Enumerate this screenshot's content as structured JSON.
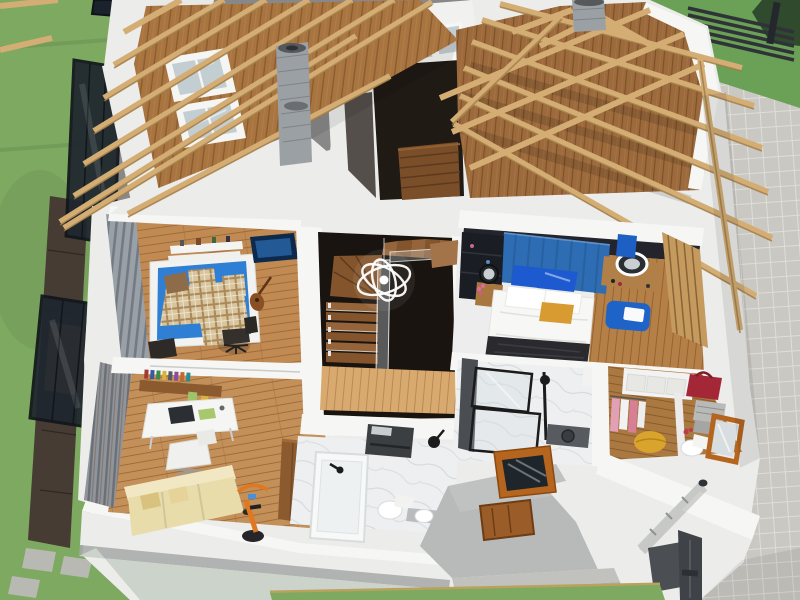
{
  "scene": {
    "title": "Aerial cutaway 3D rendering of the upper floor of a two-storey house",
    "view": "dollhouse view from above, roof partially removed showing exposed timber trusses",
    "style": "architectural visualization render, no on-screen text or UI controls"
  },
  "colors": {
    "grass": "#7da961",
    "grassTR": "#6aa156",
    "pave": "#cac8c2",
    "paveLine": "#e2e0da",
    "concrete": "#b0b0ac",
    "concreteLight": "#c1c1bd",
    "deck": "#463c33",
    "mat": "#b08f5e",
    "canopyGlass": "#1f262e",
    "canopyFrame": "#12161b",
    "wallBright": "#f6f6f4",
    "wall": "#ececea",
    "grayStripe": "#a7a9a8",
    "baseBand": "#ccd3ca",
    "beam": "#d3ad74",
    "beamEdge": "#9c7843",
    "sheathing": "#a8743f",
    "sheathSeam": "#8a5c30",
    "atticFloor": "#9c6a3c",
    "atticSeam": "#7a5128",
    "floorKid": "#c08a52",
    "floorOffice": "#c4905a",
    "floorMaster": "#b57f48",
    "floorLanding": "#d8aa70",
    "floorCloset": "#aa7841",
    "stairDark": "#1a1410",
    "tread": "#84552c",
    "treadLight": "#96643a",
    "marble": "#edeff0",
    "marbleVein": "#ccd1d5",
    "blueHead": "#2e6db4",
    "bedWhite": "#f7f7f5",
    "pillowBlue": "#1d5ad0",
    "pillowGold": "#d79b31",
    "throwDark": "#2a2a2e",
    "kidBlue": "#2f7fd4",
    "plaid": "#d8c59c",
    "plaidLine": "#a9885c",
    "sofa": "#e9dcab",
    "sofaLight": "#f1e7c2",
    "bike": "#e07820",
    "ottoman": "#1e63c8",
    "towelBlue": "#1d5fc2",
    "pouf": "#d9a32c",
    "bagRed": "#a32737",
    "clothesPink": "#e1a0b4",
    "woodCab": "#8b5a2e",
    "slatWall": "#c49a5e",
    "slatGap": "#8a6436",
    "vanityDark": "#3b3f42",
    "fixtureBlack": "#1c1c1c",
    "grayRoof": "#b7bab8",
    "skylightWood": "#b5651d",
    "doorWood": "#9a5c28",
    "pipeMetal": "#c6c9c5",
    "pipeDark": "#3f4347",
    "chimney": "#9aa0a3",
    "chimneyDark": "#7e8487",
    "glassSky": "#c3ced3",
    "fence": "#2f3337",
    "hedge": "#2f4a2c",
    "tvBlue": "#0d2a4d"
  },
  "rooms": [
    {
      "id": "kids-bedroom",
      "label": "Kids' bedroom",
      "furniture": [
        "single bed with blue mattress",
        "checkered plaid blanket and pillows",
        "floating wall shelves",
        "wall-mounted TV",
        "acoustic guitar",
        "black office chair"
      ]
    },
    {
      "id": "home-office",
      "label": "Home office / lounge",
      "furniture": [
        "wall bookshelf with colorful books",
        "white desk with laptop",
        "white swivel chair",
        "cream sofa",
        "orange exercise bike",
        "tall wooden cabinet"
      ]
    },
    {
      "id": "stair-hall",
      "label": "Staircase hall",
      "furniture": [
        "U-shaped dark wood staircase",
        "glass balustrade",
        "modern ring chandelier",
        "light parquet landing"
      ]
    },
    {
      "id": "master-bedroom",
      "label": "Master bedroom",
      "furniture": [
        "double bed with white duvet",
        "navy and white pillows",
        "gold accent pillow",
        "blue upholstered headboard wall",
        "bedside table with round mirror and flowers",
        "makeup vanity with ring-light mirror",
        "blue ottoman with white towel",
        "wood slat accent wall"
      ]
    },
    {
      "id": "walk-in-closet",
      "label": "Walk-in closet / WC",
      "furniture": [
        "white shelving with drawers",
        "red handbag",
        "grey storage baskets",
        "hanging clothes",
        "yellow pouf",
        "wood-framed leaning mirror",
        "toilet"
      ]
    },
    {
      "id": "bathroom",
      "label": "Bathroom",
      "furniture": [
        "bathtub with black faucet",
        "dark wall-hung vanity",
        "toilet",
        "pedestal basin",
        "black shower fixture"
      ]
    },
    {
      "id": "shower-room",
      "label": "Shower / laundry room",
      "furniture": [
        "black-framed glass shower",
        "dark appliance"
      ]
    },
    {
      "id": "attic",
      "label": "Open attic level",
      "furniture": [
        "exposed plank floor",
        "attic stair opening",
        "roof skylights"
      ]
    }
  ],
  "exterior": {
    "left": [
      "lawn",
      "timber deck walkway",
      "black-framed glass canopies",
      "stepping stones"
    ],
    "right": [
      "paved stone patio",
      "horizontal louver fence",
      "dark hedge"
    ],
    "bottom": [
      "white rendered facade with grey band and sage plinth",
      "flat porch roof with timber-framed skylight",
      "timber door",
      "concrete steps",
      "rain downpipes",
      "dark doormat"
    ],
    "roof": [
      "exposed timber roof trusses and purlins",
      "plank sheathing with two skylight windows",
      "two brick chimneys"
    ]
  }
}
